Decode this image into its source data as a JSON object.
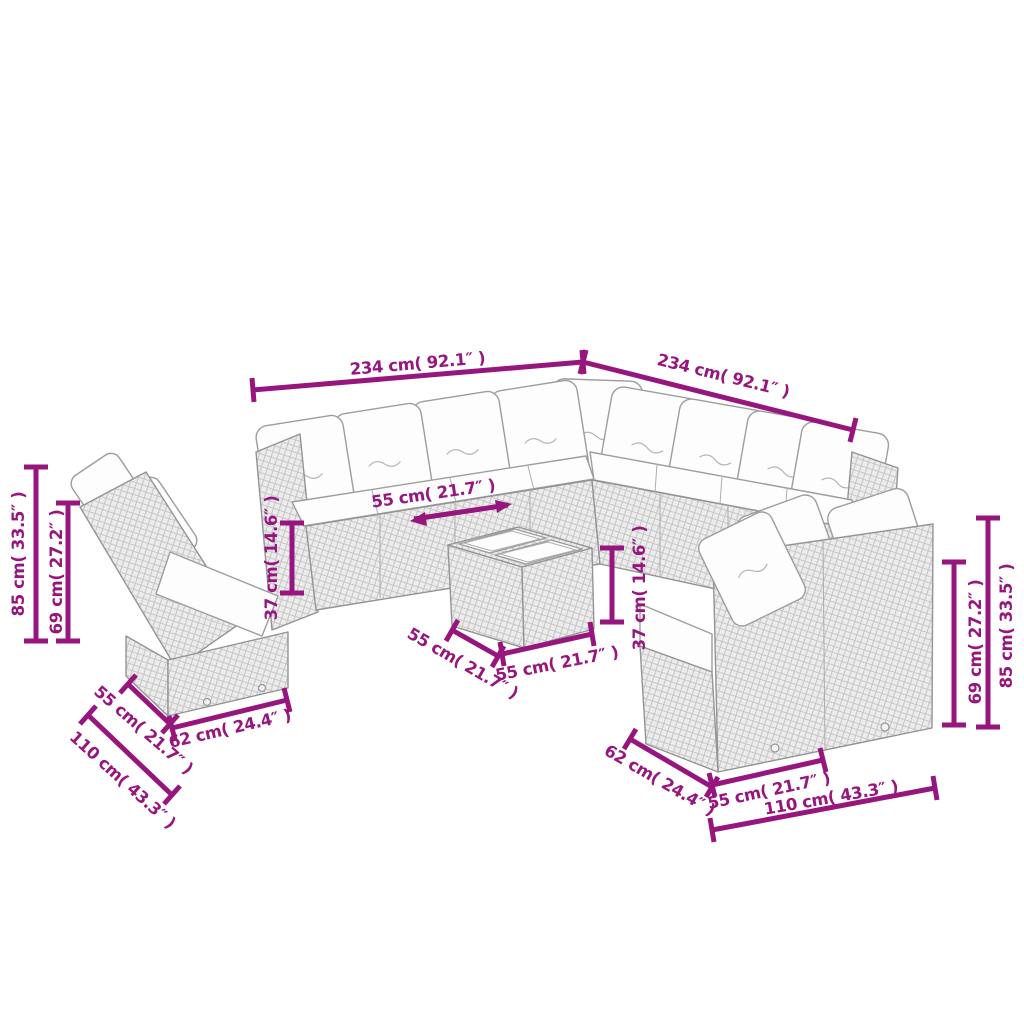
{
  "page": {
    "background": "#ffffff"
  },
  "colors": {
    "dimension_line": "#97167E",
    "line_art": "#949494",
    "rattan_fill": "#ececec",
    "cushion_fill": "#fdfdfd"
  },
  "illustration": {
    "kind": "furniture-dimension-line-drawing",
    "pieces": [
      "corner-sectional-sofa",
      "left-two-seater-sofa",
      "right-two-seater-sofa",
      "glass-top-coffee-table"
    ],
    "units": [
      "cm",
      "inches"
    ]
  },
  "dims": [
    {
      "id": "sectional-left-width",
      "label": "234 cm( 92.1″ )"
    },
    {
      "id": "sectional-right-width",
      "label": "234 cm( 92.1″ )"
    },
    {
      "id": "left-total-height",
      "label": "85 cm( 33.5″ )"
    },
    {
      "id": "left-back-height",
      "label": "69 cm( 27.2″ )"
    },
    {
      "id": "left-seat-height",
      "label": "37 cm( 14.6″ )"
    },
    {
      "id": "seat-depth",
      "label": "55 cm( 21.7″ )"
    },
    {
      "id": "table-height",
      "label": "37 cm( 14.6″ )"
    },
    {
      "id": "table-depth",
      "label": "55 cm( 21.7″ )"
    },
    {
      "id": "table-width",
      "label": "55 cm( 21.7″ )"
    },
    {
      "id": "left-sofa-depth",
      "label": "55 cm( 21.7″ )"
    },
    {
      "id": "left-sofa-seat-width",
      "label": "62 cm( 24.4″ )"
    },
    {
      "id": "left-sofa-width",
      "label": "110 cm( 43.3″ )"
    },
    {
      "id": "right-sofa-depth",
      "label": "62 cm( 24.4″ )"
    },
    {
      "id": "right-sofa-seat-width",
      "label": "55 cm( 21.7″ )"
    },
    {
      "id": "right-sofa-width",
      "label": "110 cm( 43.3″ )"
    },
    {
      "id": "right-back-height",
      "label": "69 cm( 27.2″ )"
    },
    {
      "id": "right-total-height",
      "label": "85 cm( 33.5″ )"
    }
  ]
}
